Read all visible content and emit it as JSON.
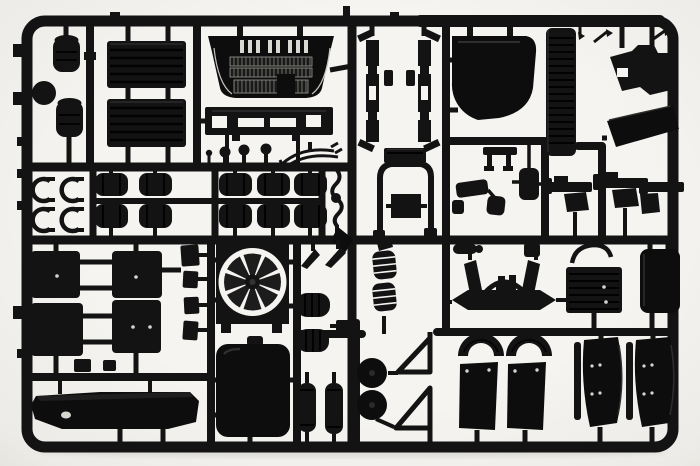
{
  "scene": {
    "subject": "Black injection-molded plastic model-kit sprue with truck cab parts photographed on a white background",
    "background_color": "#f5f4f1",
    "plastic_color": "#131313",
    "shadow_color": "#cfcdc7"
  },
  "parts": {
    "frame": {
      "label": "rounded rectangular sprue frame"
    },
    "tabs": {
      "label": "small ejector tabs on frame edge"
    },
    "runners": {
      "label": "internal sprue runner bars"
    },
    "tanks": {
      "label": "air tank cylinders and round reservoir"
    },
    "roof_panels": {
      "label": "two ribbed roof panels"
    },
    "grille": {
      "label": "truck cab front grille"
    },
    "step_panel": {
      "label": "lower grille step panel with slots"
    },
    "knobs": {
      "label": "mushroom-head fittings"
    },
    "wiper_pair": {
      "label": "curved wiper arm pair"
    },
    "drums": {
      "label": "ten cylindrical drum parts in two rows"
    },
    "clamps": {
      "label": "four C-shaped clamp parts"
    },
    "hook_lever": {
      "label": "zig-zag lever part"
    },
    "hinge_brackets": {
      "label": "mirrored door hinge brackets"
    },
    "cab_corner_panel": {
      "label": "large cab corner panel with curved cutout"
    },
    "ribbed_skirt": {
      "label": "tall ribbed side skirt column"
    },
    "engine_block": {
      "label": "engine block chunk"
    },
    "wipers_right": {
      "label": "small wiper arm parts"
    },
    "slanted_panel": {
      "label": "slanted body panel"
    },
    "hatch": {
      "label": "roof hatch frame with lid and inner panel"
    },
    "mirrors": {
      "label": "mirror housings and bracket"
    },
    "step_brackets": {
      "label": "three cab step brackets with flaps"
    },
    "gate_diamond": {
      "label": "diamond-shaped sprue gate"
    },
    "door_panels": {
      "label": "four rectangular cab door panels"
    },
    "mirror_glass": {
      "label": "column of small mirror glass plates"
    },
    "fan": {
      "label": "radiator fan inside square shroud"
    },
    "radiator_tank": {
      "label": "large solid radiator tank"
    },
    "wedges": {
      "label": "two wedge step parts"
    },
    "air_drums": {
      "label": "ribbed air reservoir drums"
    },
    "fuel_cylinders": {
      "label": "two vertical fuel tank cylinders"
    },
    "springs": {
      "label": "pair of coil springs"
    },
    "chassis_bracket": {
      "label": "chassis bracket with two round hubs and triangular gussets"
    },
    "axle_wing": {
      "label": "front axle beam with twin fins"
    },
    "fittings": {
      "label": "small pipe and canister fittings"
    },
    "radiator_core": {
      "label": "ribbed radiator core"
    },
    "intercooler": {
      "label": "intercooler panel"
    },
    "front_bumper": {
      "label": "wide front bumper"
    },
    "front_fenders": {
      "label": "two front wheel arches with mud flaps"
    },
    "rear_fenders": {
      "label": "two curved rear quarter fenders"
    },
    "shadow": {
      "label": "soft shadow under sprue"
    }
  }
}
